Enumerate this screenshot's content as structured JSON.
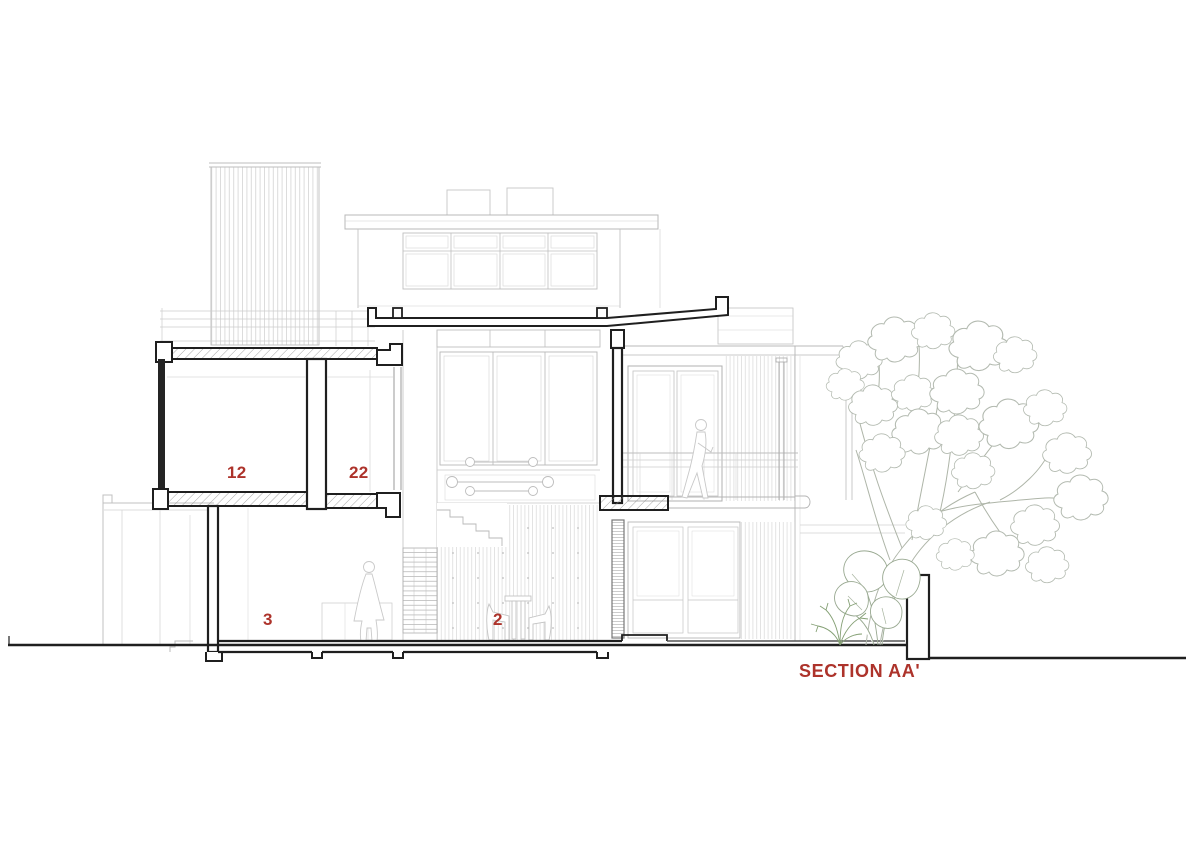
{
  "drawing": {
    "type": "architectural-section",
    "title": "SECTION AA'",
    "room_labels": [
      {
        "id": "room-12",
        "text": "12"
      },
      {
        "id": "room-22",
        "text": "22"
      },
      {
        "id": "room-3",
        "text": "3"
      },
      {
        "id": "room-2",
        "text": "2"
      }
    ],
    "colors": {
      "label_red": "#ad332b",
      "cut_line": "#1f1f1f",
      "light_line": "#b4b4b4",
      "plant_line": "#a7b0a0",
      "background": "#ffffff"
    }
  }
}
